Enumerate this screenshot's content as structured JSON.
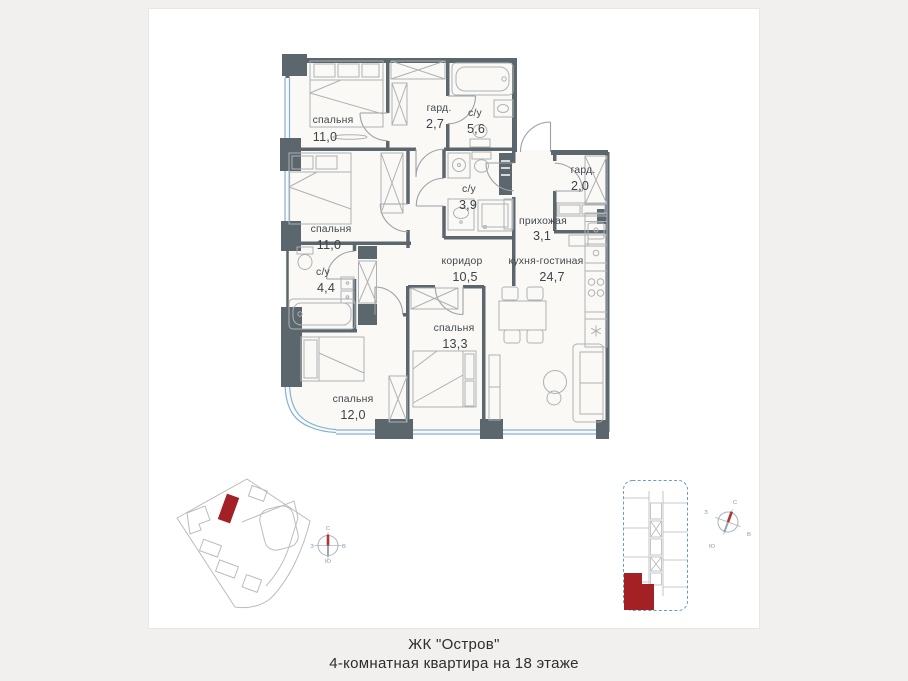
{
  "page": {
    "background": "#f1f0ee",
    "card_background": "#ffffff",
    "card_border": "#e8e7e4"
  },
  "colors": {
    "wall": "#5c666d",
    "furniture_stroke": "#adb2b6",
    "door_arc": "#9ba1a7",
    "window_glass": "#7fb2d6",
    "highlight_red": "#a32024",
    "room_label": "#41484e",
    "siteplan_outline": "#bcbcba",
    "keyplan_dash": "#6f9cc6",
    "compass_letter": "#8699ae",
    "compass_needle": "#ac3732"
  },
  "caption": {
    "line1": "ЖК \"Остров\"",
    "line2": "4-комнатная квартира на 18 этаже"
  },
  "rooms": [
    {
      "id": "bedroom-1",
      "name": "спальня",
      "area": "11,0"
    },
    {
      "id": "wardrobe-1",
      "name": "гард.",
      "area": "2,7"
    },
    {
      "id": "bathroom-1",
      "name": "с/у",
      "area": "5,6"
    },
    {
      "id": "bedroom-2",
      "name": "спальня",
      "area": "11,0"
    },
    {
      "id": "bathroom-2",
      "name": "с/у",
      "area": "3,9"
    },
    {
      "id": "wardrobe-2",
      "name": "гард.",
      "area": "2,0"
    },
    {
      "id": "hallway",
      "name": "прихожая",
      "area": "3,1"
    },
    {
      "id": "bathroom-3",
      "name": "с/у",
      "area": "4,4"
    },
    {
      "id": "corridor",
      "name": "коридор",
      "area": "10,5"
    },
    {
      "id": "kitchen-living",
      "name": "кухня-гостиная",
      "area": "24,7"
    },
    {
      "id": "bedroom-3",
      "name": "спальня",
      "area": "13,3"
    },
    {
      "id": "bedroom-4",
      "name": "спальня",
      "area": "12,0"
    }
  ],
  "compass": {
    "north": "С",
    "east": "В",
    "south": "Ю",
    "west": "З"
  }
}
